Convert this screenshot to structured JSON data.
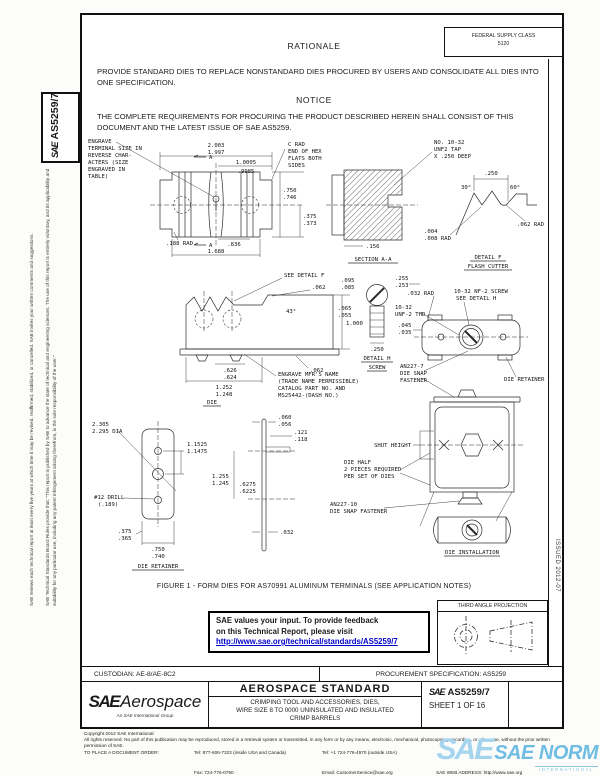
{
  "sidebar": {
    "board_rules": "SAE Technical Standards Board Rules provide that: \"This report is published by SAE to advance the state of technical and engineering sciences. The use of this report is entirely voluntary, and its applicability and suitability for any particular use, including any patent infringement arising therefrom, is the sole responsibility of the user.\"",
    "review_note": "SAE reviews each technical report at least every five years at which time it may be revised, reaffirmed, stabilized, or cancelled. SAE invites your written comments and suggestions.",
    "sae": "SAE",
    "doc_number": "AS5259/7"
  },
  "header": {
    "fsc_line1": "FEDERAL SUPPLY CLASS",
    "fsc_line2": "5120",
    "rationale_title": "RATIONALE",
    "rationale_body": "PROVIDE STANDARD DIES TO REPLACE NONSTANDARD DIES PROCURED BY USERS AND CONSOLIDATE ALL DIES INTO ONE SPECIFICATION.",
    "notice_title": "NOTICE",
    "notice_body": "THE COMPLETE REQUIREMENTS FOR PROCURING THE PRODUCT DESCRIBED HEREIN SHALL CONSIST OF THIS DOCUMENT AND THE LATEST ISSUE OF SAE AS5259."
  },
  "figure_caption": "FIGURE 1 - FORM DIES FOR AS70991 ALUMINUM TERMINALS (SEE APPLICATION NOTES)",
  "fig": {
    "a_n1": "ENGRAVE",
    "a_n2": "TERMINAL SIZE IN",
    "a_n3": "REVERSE CHAR-",
    "a_n4": "ACTERS (SIZE",
    "a_n5": "ENGRAVED IN",
    "a_n6": "TABLE)",
    "a_d1": "2.003",
    "a_d2": "1.997",
    "a_d3": "1.0005",
    "a_d4": ".9985",
    "a_c1": "C RAD",
    "a_c2": "END OF HEX",
    "a_c3": "FLATS BOTH",
    "a_c4": "SIDES",
    "a_d5": ".750",
    "a_d6": ".746",
    "a_d7": ".375",
    "a_d8": ".373",
    "a_d9": ".188 RAD",
    "a_d10": ".836",
    "a_d11": "1.688",
    "a_ar": "A",
    "b_t1": "NO. 10-32",
    "b_t2": "UNF2 TAP",
    "b_t3": "X .250 DEEP",
    "b_d1": ".156",
    "b_ti": "SECTION A-A",
    "f_d1": ".250",
    "f_a1": "30°",
    "f_a2": "60°",
    "f_d2": ".062 RAD",
    "f_d3": ".004",
    "f_d4": ".008 RAD",
    "f_t1": "DETAIL F",
    "f_t2": "FLASH CUTTER",
    "d_sd": "SEE DETAIL F",
    "d_d1": ".062",
    "d_a1": "43°",
    "d_d2": "1.000",
    "d_d3": ".062",
    "d_d4": ".626",
    "d_d5": ".624",
    "d_d6": "1.252",
    "d_d7": "1.248",
    "d_m1": "ENGRAVE MFR'S NAME",
    "d_m2": "(TRADE NAME PERMISSIBLE)",
    "d_m3": "CATALOG PART NO. AND",
    "d_m4": "MS25442-(DASH NO.)",
    "d_ti": "DIE",
    "h_d1": ".095",
    "h_d2": ".085",
    "h_d3": ".065",
    "h_d4": ".055",
    "h_d5": ".250",
    "h_t1": "DETAIL H",
    "h_t2": "SCREW",
    "e_d1": ".255",
    "e_d2": ".253",
    "e_d3": ".032 RAD",
    "e_d4": "10-32",
    "e_d5": "UNF-2 THD",
    "e_d6": ".045",
    "e_d7": ".035",
    "e_n1": "10-32 NF-2 SCREW",
    "e_n2": "SEE DETAIL H",
    "e_f1": "AN227-7",
    "e_f2": "DIE SNAP",
    "e_f3": "FASTENER",
    "e_rt": "DIE RETAINER",
    "r_d1": "2.305",
    "r_d2": "2.295 DIA",
    "r_d3": "1.1525",
    "r_d4": "1.1475",
    "r_d5": "#12 DRILL",
    "r_d6": "(.189)",
    "r_d7": ".375",
    "r_d8": ".365",
    "r_d9": ".750",
    "r_d10": ".740",
    "r_ti": "DIE RETAINER",
    "g_d1": ".060",
    "g_d2": ".056",
    "g_d3": ".121",
    "g_d4": ".118",
    "g_d5": "1.255",
    "g_d6": "1.245",
    "g_d7": ".6275",
    "g_d8": ".6225",
    "g_d9": ".032",
    "i_sh": "SHUT HEIGHT",
    "i_h1": "DIE HALF",
    "i_h2": "2 PIECES REQUIRED",
    "i_h3": "PER SET OF DIES",
    "i_f1": "AN227-10",
    "i_f2": "DIE SNAP FASTENER",
    "i_ti": "DIE INSTALLATION"
  },
  "feedback": {
    "line1": "SAE values your input. To provide feedback",
    "line2": "on this Technical Report, please visit",
    "link": "http://www.sae.org/technical/standards/AS5259/7"
  },
  "projection": {
    "title": "THIRD ANGLE PROJECTION"
  },
  "margin_note": "ISSUED 2012-07",
  "footer": {
    "custodian": "CUSTODIAN: AE-8/AE-8C2",
    "procurement": "PROCUREMENT SPECIFICATION: AS5259",
    "brand_sae": "SAE",
    "brand_aero": "Aerospace",
    "brand_tag": "An SAE International Group",
    "doc_type": "AEROSPACE STANDARD",
    "title_l1": "CRIMPING TOOL AND ACCESSORIES, DIES,",
    "title_l2": "WIRE SIZE 8 TO 0000 UNINSULATED AND INSULATED",
    "title_l3": "CRIMP BARRELS",
    "num_sae": "SAE",
    "num": "AS5259/7",
    "sheet": "SHEET 1 OF 16"
  },
  "copyright": {
    "line1": "Copyright 2012 SAE International",
    "line2": "All rights reserved. No part of this publication may be reproduced, stored in a retrieval system or transmitted, in any form or by any means, electronic, mechanical, photocopying, recording, or otherwise, without the prior written permission of SAE.",
    "order_label": "TO PLACE A DOCUMENT ORDER:",
    "tel1": "Tel: 877-606-7323 (inside USA and Canada)",
    "tel2": "Tel: +1 724-776-4970 (outside USA)",
    "fax": "Fax: 724-776-0790",
    "email": "Email: CustomerService@sae.org",
    "web": "SAE WEB ADDRESS: http://www.sae.org"
  },
  "watermark": {
    "sae": "SAE",
    "norm": "SAE NORM",
    "sub": "INTERNATIONAL"
  }
}
